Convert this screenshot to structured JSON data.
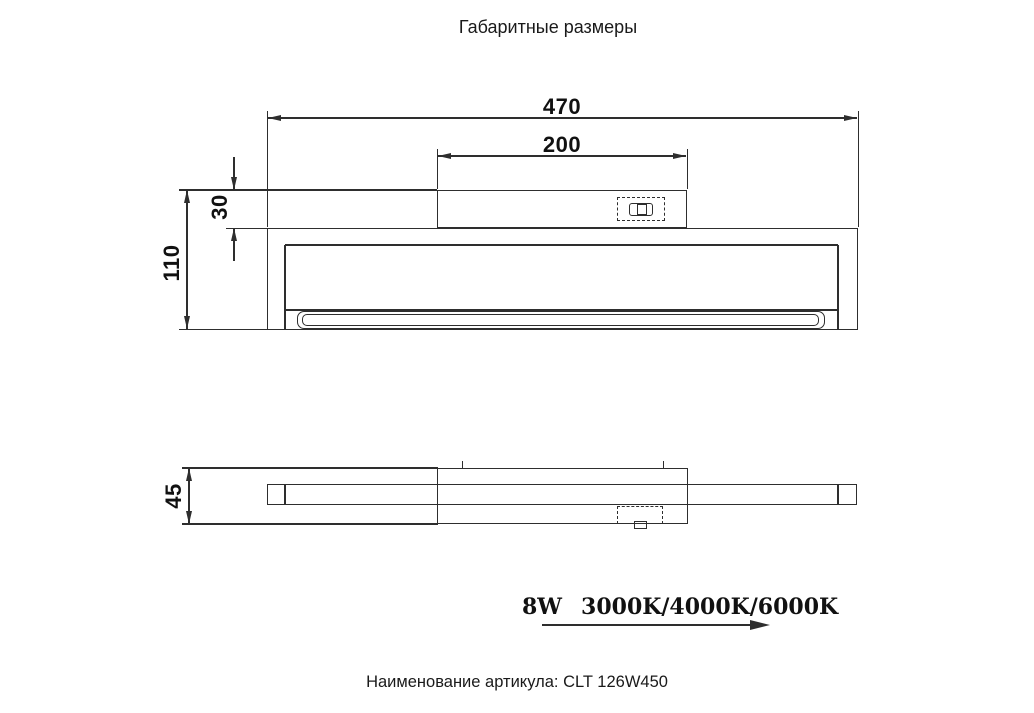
{
  "title": "Габаритные размеры",
  "dimensions": {
    "overall_width": "470",
    "mount_width": "200",
    "mount_height": "30",
    "overall_height": "110",
    "depth": "45"
  },
  "specs": {
    "wattage": "8W",
    "color_temperatures": "3000K/4000K/6000K"
  },
  "footer": "Наименование артикула: CLT 126W450",
  "icons": {
    "connector": "power-connector-icon",
    "direction": "right-arrow-icon"
  },
  "colors": {
    "line": "#2e2e2e",
    "text": "#111111",
    "background": "#ffffff"
  }
}
